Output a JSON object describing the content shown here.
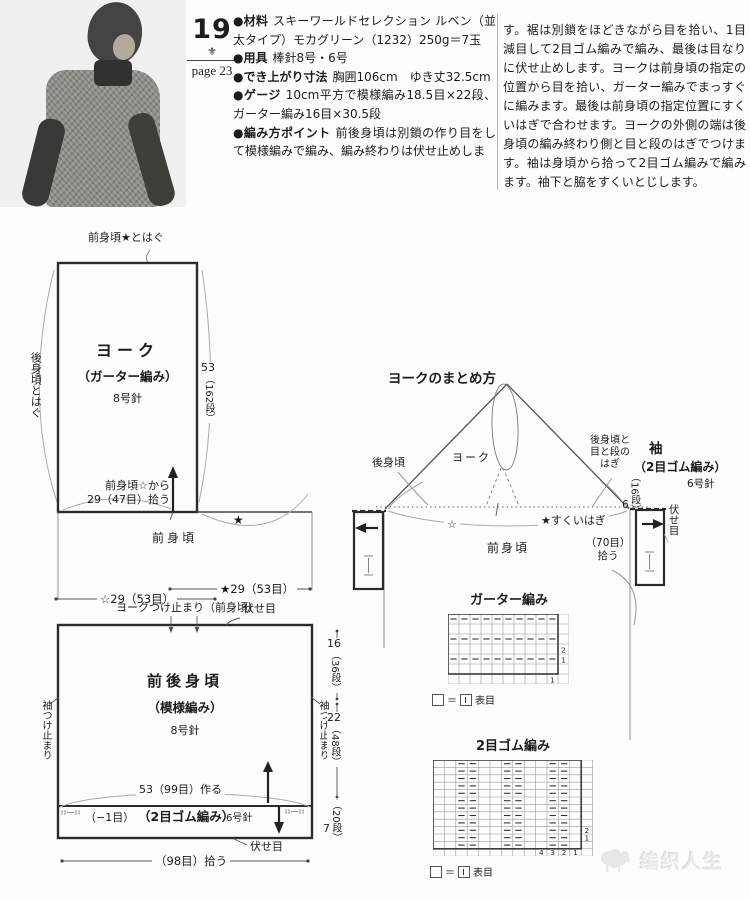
{
  "page": {
    "number": "19",
    "ornament_glyph": "⚜",
    "page_ref": "page 23",
    "watermark": "编织人生"
  },
  "info": {
    "items": [
      {
        "label": "●材料",
        "text": "スキーワールドセレクション ルベン（並太タイプ）モカグリーン（1232）250g＝7玉"
      },
      {
        "label": "●用具",
        "text": "棒針8号・6号"
      },
      {
        "label": "●でき上がり寸法",
        "text": "胸囲106cm　ゆき丈32.5cm"
      },
      {
        "label": "●ゲージ",
        "text": "10cm平方で模様編み18.5目×22段、ガーター編み16目×30.5段"
      },
      {
        "label": "●編み方ポイント",
        "text": "前後身頃は別鎖の作り目をして模様編みで編み、編み終わりは伏せ止めしま"
      }
    ],
    "continuation": "す。裾は別鎖をほどきながら目を拾い、1目減目して2目ゴム編みで編み、最後は目なりに伏せ止めします。ヨークは前身頃の指定の位置から目を拾い、ガーター編みでまっすぐに編みます。最後は前身頃の指定位置にすくいはぎで合わせます。ヨークの外側の端は後身頃の編み終わり側と目と段のはぎでつけます。袖は身頃から拾って2目ゴム編みで編みます。袖下と脇をすくいとじします。"
  },
  "yoke": {
    "top_seam": "前身頃★とはぐ",
    "left_seam": "後身頃とはぐ",
    "name": "ヨーク",
    "stitch": "（ガーター編み）",
    "needle": "8号針",
    "rows_main": "53",
    "rows_sub": "（162段）",
    "pickup_line1": "前身頃☆から",
    "pickup_line2": "29（47目）拾う",
    "star": "★",
    "front_body": "前身頃"
  },
  "measures": {
    "star_width": "★29（53目）",
    "open_star_width": "☆29（53目）"
  },
  "body": {
    "attach": "ヨークつけ止まり（前身頃）",
    "bindoff_top": "伏せ目",
    "name": "前後身頃",
    "stitch": "（模様編み）",
    "needle": "8号針",
    "sleeve_stop_left": "袖つけ止まり",
    "sleeve_stop_right": "袖つけ止まり",
    "dim1_main": "16",
    "dim1_sub": "（36段）",
    "dim2_main": "22",
    "dim2_sub": "（48段）",
    "dim3_main": "7",
    "dim3_sub": "（20段）",
    "cast_on": "53（99目）作る",
    "minus": "（−1目）",
    "rib_stitch": "（2目ゴム編み）",
    "rib_needle": "6号針",
    "bindoff_bottom": "伏せ目",
    "pickup_bottom": "（98目）拾う"
  },
  "assembly": {
    "title": "ヨークのまとめ方",
    "back_body": "後身頃",
    "yoke": "ヨーク",
    "seam_line1": "後身頃と",
    "seam_line2": "目と段の",
    "seam_line3": "はぎ",
    "sleeve": "袖",
    "sleeve_stitch": "（2目ゴム編み）",
    "sleeve_needle": "6号針",
    "dim_main": "6",
    "dim_sub": "（16段）",
    "bindoff": "伏せ目",
    "open_star": "☆",
    "graft": "★すくいはぎ",
    "front_body": "前身頃",
    "pickup_line1": "（70目）",
    "pickup_line2": "拾う"
  },
  "charts": {
    "garter": {
      "title": "ガーター編み",
      "pattern_cols": 10,
      "pattern_rows": 6,
      "purl_rows": [
        1,
        3,
        5
      ],
      "right_numbers": [
        {
          "row": 4,
          "t": "2"
        },
        {
          "row": 5,
          "t": "1"
        }
      ],
      "bottom_numbers": [
        {
          "col": 10,
          "t": "1"
        }
      ],
      "legend_eq": "＝",
      "legend_label": "表目"
    },
    "rib": {
      "title": "2目ゴム編み",
      "pattern_cols": 13,
      "pattern_rows": 12,
      "purl_col_pairs": [
        [
          3,
          4
        ],
        [
          7,
          8
        ],
        [
          11,
          12
        ]
      ],
      "right_numbers": [
        {
          "row": 10,
          "t": "2"
        },
        {
          "row": 11,
          "t": "1"
        }
      ],
      "bottom_numbers": [
        {
          "col": 10,
          "t": "4"
        },
        {
          "col": 11,
          "t": "3"
        },
        {
          "col": 12,
          "t": "2"
        },
        {
          "col": 13,
          "t": "1"
        }
      ],
      "legend_eq": "＝",
      "legend_label": "表目"
    }
  }
}
